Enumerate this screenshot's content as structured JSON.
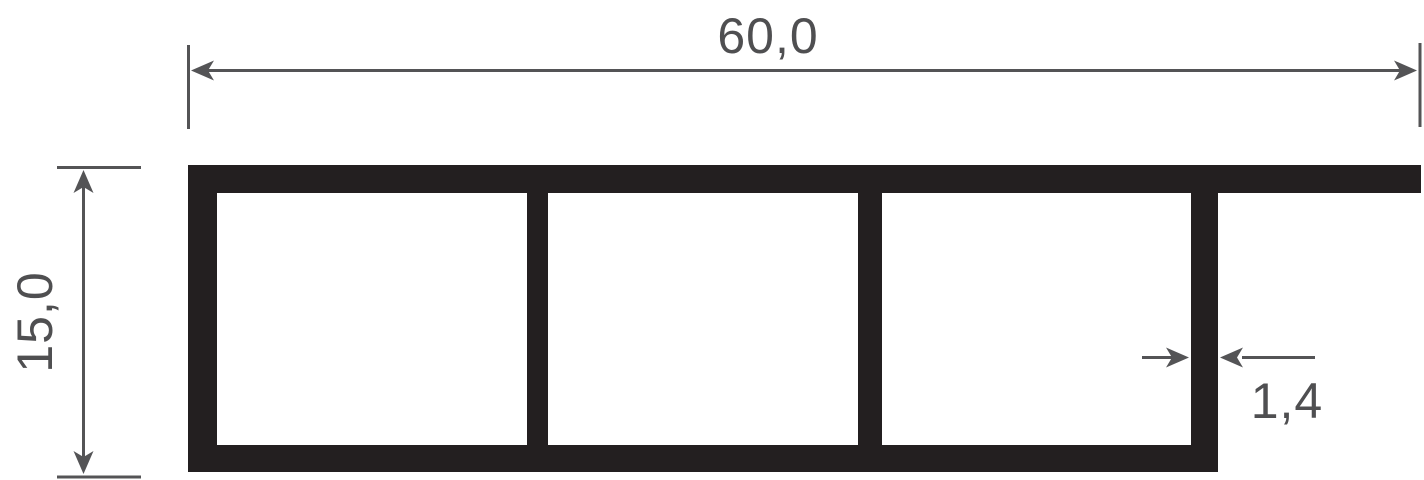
{
  "drawing": {
    "title": "profile-cross-section",
    "dimensions": {
      "width": {
        "label": "60,0"
      },
      "height": {
        "label": "15,0"
      },
      "wall_thickness": {
        "label": "1,4"
      }
    },
    "chamber_count": "3"
  },
  "colors": {
    "profile": "#231f20",
    "dimension_line": "#545456",
    "dimension_text": "#4f4f51",
    "background": "#ffffff"
  }
}
